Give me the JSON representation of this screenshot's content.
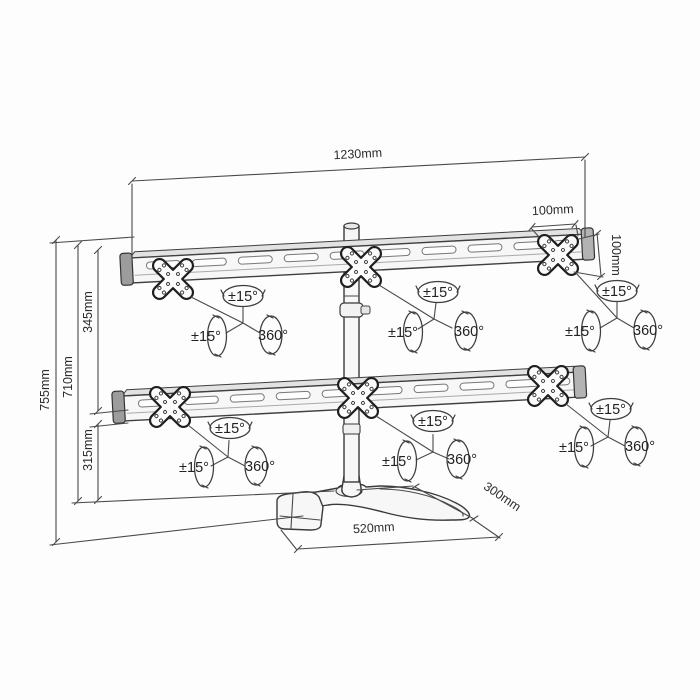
{
  "diagram": {
    "product": "six-monitor desk stand dimension drawing",
    "line_color": "#3a3a3a",
    "background": "#fdfdfd"
  },
  "dimensions": {
    "rail_length": "1230mm",
    "vesa_width": "100mm",
    "vesa_height": "100mm",
    "total_height": "755mm",
    "column_height": "710mm",
    "upper_offset": "345mm",
    "lower_offset": "315mm",
    "base_length": "520mm",
    "base_depth": "300mm"
  },
  "rotation": {
    "tilt": "±15°",
    "swivel": "±15°",
    "rotate": "360°"
  }
}
